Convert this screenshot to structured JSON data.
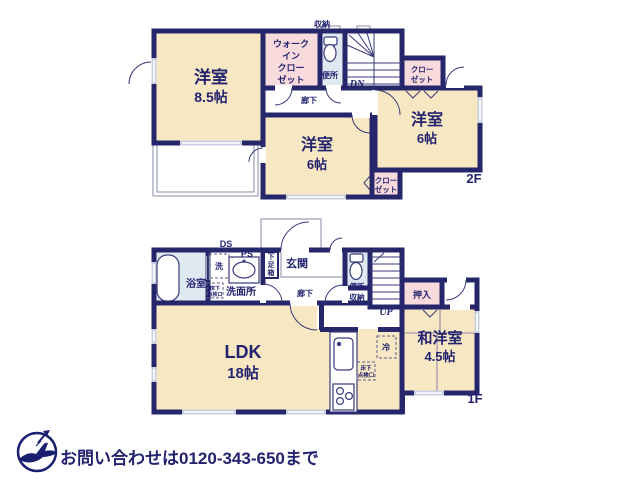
{
  "colors": {
    "wall_navy": "#26266B",
    "room_cream": "#F7E8C3",
    "closet_pink": "#F9DBDD",
    "wet_blue": "#DEE9F2",
    "window_gray": "#C9CFE3",
    "footer_gray": "#C9C9C9",
    "logo_navy": "#1A2070"
  },
  "f2": {
    "floor": "2F",
    "shuno": "収納",
    "wic": [
      "ウォーク",
      "イン",
      "クロー",
      "ゼット"
    ],
    "benjo": "便所",
    "dn": "DN",
    "rouka": "廊下",
    "closet": [
      "クロー",
      "ゼット"
    ],
    "r85": {
      "name": "洋室",
      "size": "8.5帖"
    },
    "r6c": {
      "name": "洋室",
      "size": "6帖"
    },
    "r6r": {
      "name": "洋室",
      "size": "6帖"
    }
  },
  "f1": {
    "floor": "1F",
    "ds": "DS",
    "bath": "浴室",
    "wash": "洗",
    "ps": "PS",
    "senmen": "洗面所",
    "yukashita": [
      "床下",
      "点検口"
    ],
    "getabako": [
      "下",
      "足",
      "箱"
    ],
    "genkan": "玄関",
    "rouka": "廊下",
    "benjo": "便所",
    "shuno": "収納",
    "up": "UP",
    "oshiire": "押入",
    "rei": "冷",
    "ldk": {
      "name": "LDK",
      "size": "18帖"
    },
    "washitsu": {
      "name": "和洋室",
      "size": "4.5帖"
    }
  },
  "footer": {
    "contact": "お問い合わせは0120-343-650まで"
  }
}
